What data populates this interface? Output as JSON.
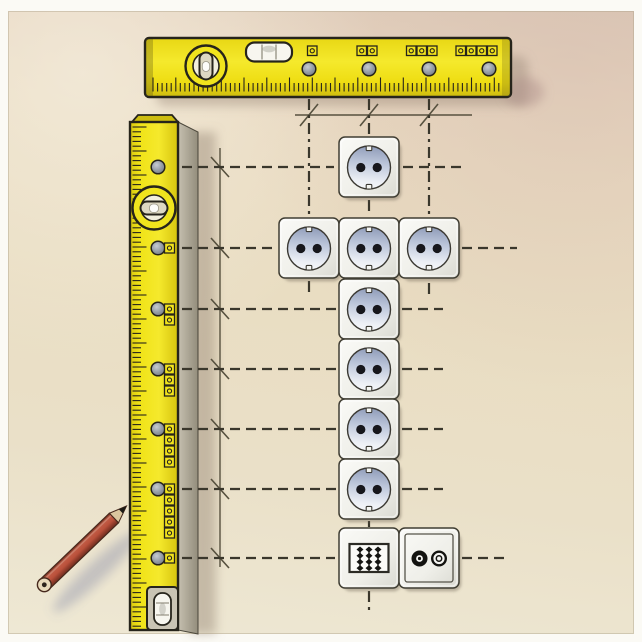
{
  "meta": {
    "subject": "instructional illustration of wall-socket installation marked out with spirit levels and a pencil",
    "canvas": {
      "width": 642,
      "height": 642
    },
    "visible_text": ""
  },
  "palette": {
    "paper": "#fbfaf5",
    "wall_top": "#dcc9b8",
    "wall_mid": "#e9dcc2",
    "wall_bottom": "#eee8d4",
    "level_yellow": "#f2e41c",
    "level_yellow_dark": "#cdbb10",
    "level_outline": "#26241b",
    "level_side_gray": "#a8a292",
    "socket_plate": "#f4f4f0",
    "socket_face_blue": "#94a0bc",
    "socket_hole": "#17171c",
    "guide_dash": "#3a372c",
    "pencil_line": "#57513f",
    "pencil_red": "#b0513f",
    "shadow": "rgba(110,100,85,0.40)"
  },
  "horizontal_level": {
    "x": 145,
    "y": 38,
    "w": 366,
    "h": 59,
    "holes_x": [
      309,
      369,
      429,
      489
    ],
    "hole_y": 69,
    "marker_counts": [
      1,
      2,
      3,
      4
    ],
    "marker_y": 46,
    "vials": [
      "bullseye-vial",
      "tube-vial"
    ],
    "ticks": {
      "x1": 153,
      "x2": 503,
      "baseline_y": 91.5,
      "step": 4.55,
      "short": 8.5,
      "tall": 14
    }
  },
  "vertical_level": {
    "x": 130,
    "y": 122,
    "w": 48,
    "h": 508,
    "hole_x": 158,
    "holes_y": [
      167,
      248,
      309,
      369,
      429,
      489,
      558
    ],
    "marker_counts": [
      0,
      1,
      2,
      3,
      4,
      5,
      1
    ],
    "marker_x": 164.5,
    "vials": [
      "bullseye-vial",
      "tube-vial"
    ],
    "ticks": {
      "y1": 127,
      "y2": 627,
      "edge_x": 132.5,
      "step": 4.8,
      "short": 8.5,
      "tall": 14
    }
  },
  "sockets": {
    "size": 60,
    "items": [
      {
        "type": "schuko",
        "x": 339,
        "y": 137
      },
      {
        "type": "schuko",
        "x": 279,
        "y": 218
      },
      {
        "type": "schuko",
        "x": 339,
        "y": 218
      },
      {
        "type": "schuko",
        "x": 399,
        "y": 218
      },
      {
        "type": "schuko",
        "x": 339,
        "y": 279
      },
      {
        "type": "schuko",
        "x": 339,
        "y": 339
      },
      {
        "type": "schuko",
        "x": 339,
        "y": 399
      },
      {
        "type": "schuko",
        "x": 339,
        "y": 459
      },
      {
        "type": "data",
        "x": 339,
        "y": 528
      },
      {
        "type": "tv",
        "x": 399,
        "y": 528
      }
    ]
  },
  "guides": {
    "solid_lines": [
      {
        "type": "h",
        "y": 115,
        "x1": 295,
        "x2": 472,
        "tick_marks_x": [
          309,
          369,
          429
        ]
      },
      {
        "type": "v",
        "x": 220,
        "y1": 148,
        "y2": 567,
        "tick_marks_y": [
          167,
          248,
          309,
          369,
          429,
          489,
          558
        ]
      }
    ],
    "dashed_horizontal": [
      {
        "y": 167,
        "segments": [
          [
            182,
            334
          ],
          [
            403,
            462
          ]
        ]
      },
      {
        "y": 248,
        "segments": [
          [
            182,
            276
          ],
          [
            462,
            517
          ]
        ]
      },
      {
        "y": 309,
        "segments": [
          [
            182,
            336
          ],
          [
            402,
            443
          ]
        ]
      },
      {
        "y": 369,
        "segments": [
          [
            182,
            336
          ],
          [
            402,
            443
          ]
        ]
      },
      {
        "y": 429,
        "segments": [
          [
            182,
            336
          ],
          [
            402,
            443
          ]
        ]
      },
      {
        "y": 489,
        "segments": [
          [
            182,
            336
          ],
          [
            402,
            443
          ]
        ]
      },
      {
        "y": 558,
        "segments": [
          [
            182,
            335
          ],
          [
            462,
            510
          ]
        ]
      }
    ],
    "dashed_vertical": [
      {
        "x": 309,
        "segments": [
          [
            99,
            215
          ],
          [
            281,
            296
          ]
        ]
      },
      {
        "x": 369,
        "segments": [
          [
            99,
            134
          ],
          [
            200,
            215
          ],
          [
            521,
            527
          ],
          [
            591,
            613
          ]
        ]
      },
      {
        "x": 429,
        "segments": [
          [
            99,
            215
          ],
          [
            283,
            296
          ]
        ]
      }
    ]
  },
  "pencil": {
    "tip": [
      126.5,
      506
    ],
    "butt": [
      44,
      585
    ],
    "color": "#b0513f"
  }
}
